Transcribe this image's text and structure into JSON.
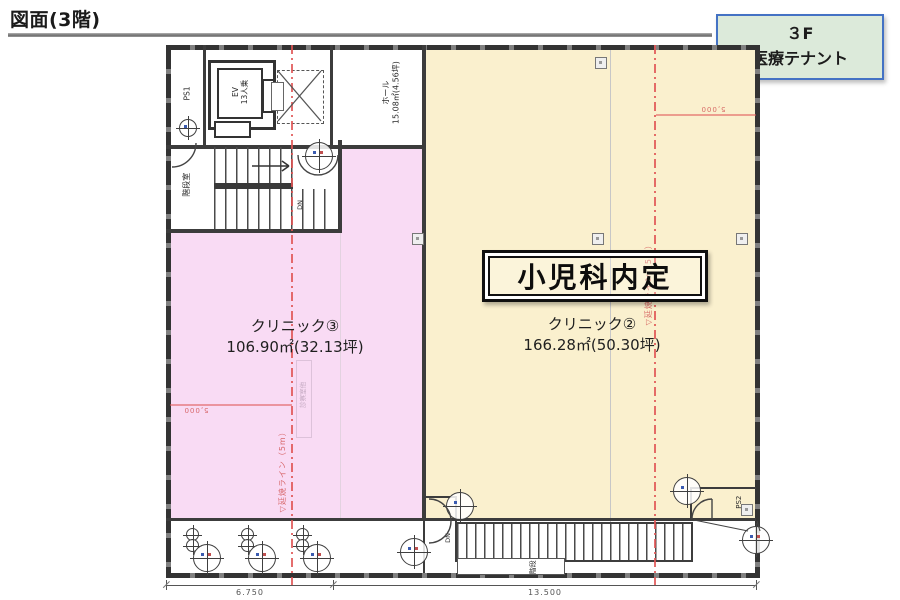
{
  "page": {
    "title": "図面(3階)"
  },
  "floor_tag": {
    "line1": "３F",
    "line2": "医療テナント"
  },
  "zones": {
    "clinic3": {
      "name": "クリニック③",
      "area": "106.90㎡(32.13坪)"
    },
    "clinic2": {
      "name": "クリニック②",
      "area": "166.28㎡(50.30坪)",
      "tenant": "小児科内定"
    }
  },
  "labels": {
    "hall_name": "ホール",
    "hall_area": "15.08㎡(4.56坪)",
    "ev_line1": "EV",
    "ev_line2": "13人乗",
    "ps1": "PS1",
    "ps2": "PS2",
    "stair_room": "階段室",
    "exterior_stair": "階段",
    "dn_inner": "DN",
    "dn_outer": "DN",
    "consult_room_faint": "診察室他"
  },
  "annotations": {
    "fire_line_left": "▽延焼ライン（5m）",
    "fire_line_right": "▽延焼ライン（5m）",
    "grid_dim_left": "5,000",
    "grid_dim_right": "5,000"
  },
  "dimensions": {
    "width_left": "6.750",
    "width_right": "13.500"
  },
  "colors": {
    "clinic3_fill": "#F9DBF4",
    "clinic2_fill": "#FAF0CE",
    "tag_fill": "#DCEADA",
    "tag_border": "#4472C4",
    "wall": "#3C3C3C",
    "fire_line": "#E06060"
  }
}
